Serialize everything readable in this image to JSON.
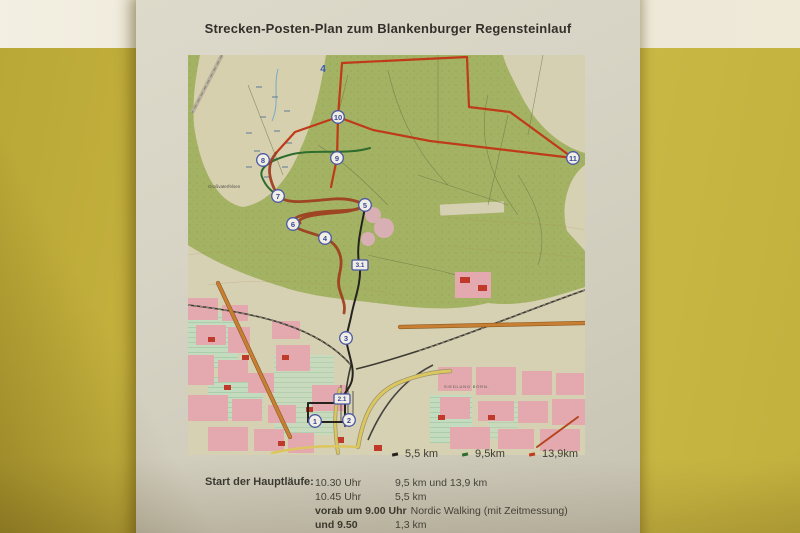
{
  "poster": {
    "title": "Strecken-Posten-Plan zum Blankenburger Regensteinlauf",
    "map": {
      "sheet_number": "4",
      "checkpoints": [
        {
          "label": "4",
          "type": "plain",
          "x": 135,
          "y": 14
        },
        {
          "label": "10",
          "type": "circle",
          "x": 150,
          "y": 62
        },
        {
          "label": "8",
          "type": "circle",
          "x": 75,
          "y": 105
        },
        {
          "label": "9",
          "type": "circle",
          "x": 149,
          "y": 103
        },
        {
          "label": "11",
          "type": "circle",
          "x": 385,
          "y": 103
        },
        {
          "label": "7",
          "type": "circle",
          "x": 90,
          "y": 141
        },
        {
          "label": "5",
          "type": "circle",
          "x": 177,
          "y": 150
        },
        {
          "label": "6",
          "type": "circle",
          "x": 105,
          "y": 169
        },
        {
          "label": "4",
          "type": "circle",
          "x": 137,
          "y": 183
        },
        {
          "label": "3.1",
          "type": "box",
          "x": 172,
          "y": 210
        },
        {
          "label": "3",
          "type": "circle",
          "x": 158,
          "y": 283
        },
        {
          "label": "2.1",
          "type": "box",
          "x": 154,
          "y": 344
        },
        {
          "label": "1",
          "type": "circle",
          "x": 127,
          "y": 366
        },
        {
          "label": "2",
          "type": "circle",
          "x": 161,
          "y": 365
        }
      ],
      "region_labels": [
        {
          "text": "Großvaterfelsen",
          "x": 20,
          "y": 133,
          "caps": false
        },
        {
          "text": "SIEDLUNG BÖRN.",
          "x": 256,
          "y": 333,
          "caps": true
        }
      ],
      "routes": [
        {
          "distance": "13,9 km",
          "color": "#bf3a18"
        },
        {
          "distance": "9,5 km",
          "color": "#2f6d2f"
        },
        {
          "distance": "5,5 km",
          "color": "#26231f"
        }
      ],
      "legend": [
        {
          "label": "5,5 km",
          "color": "#26231f"
        },
        {
          "label": "9,5km",
          "color": "#2f6d2f"
        },
        {
          "label": "13,9km",
          "color": "#bf3a18"
        }
      ]
    },
    "schedule": {
      "heading": "Start der Hauptläufe:",
      "rows": [
        {
          "time": "10.30 Uhr",
          "details": "9,5 km und 13,9 km",
          "bold": false
        },
        {
          "time": "10.45 Uhr",
          "details": "5,5 km",
          "bold": false
        },
        {
          "time": "vorab um 9.00 Uhr",
          "details": "Nordic Walking (mit Zeitmessung)",
          "bold": true
        },
        {
          "time": "und 9.50",
          "details": "1,3 km",
          "bold": true
        }
      ]
    }
  }
}
